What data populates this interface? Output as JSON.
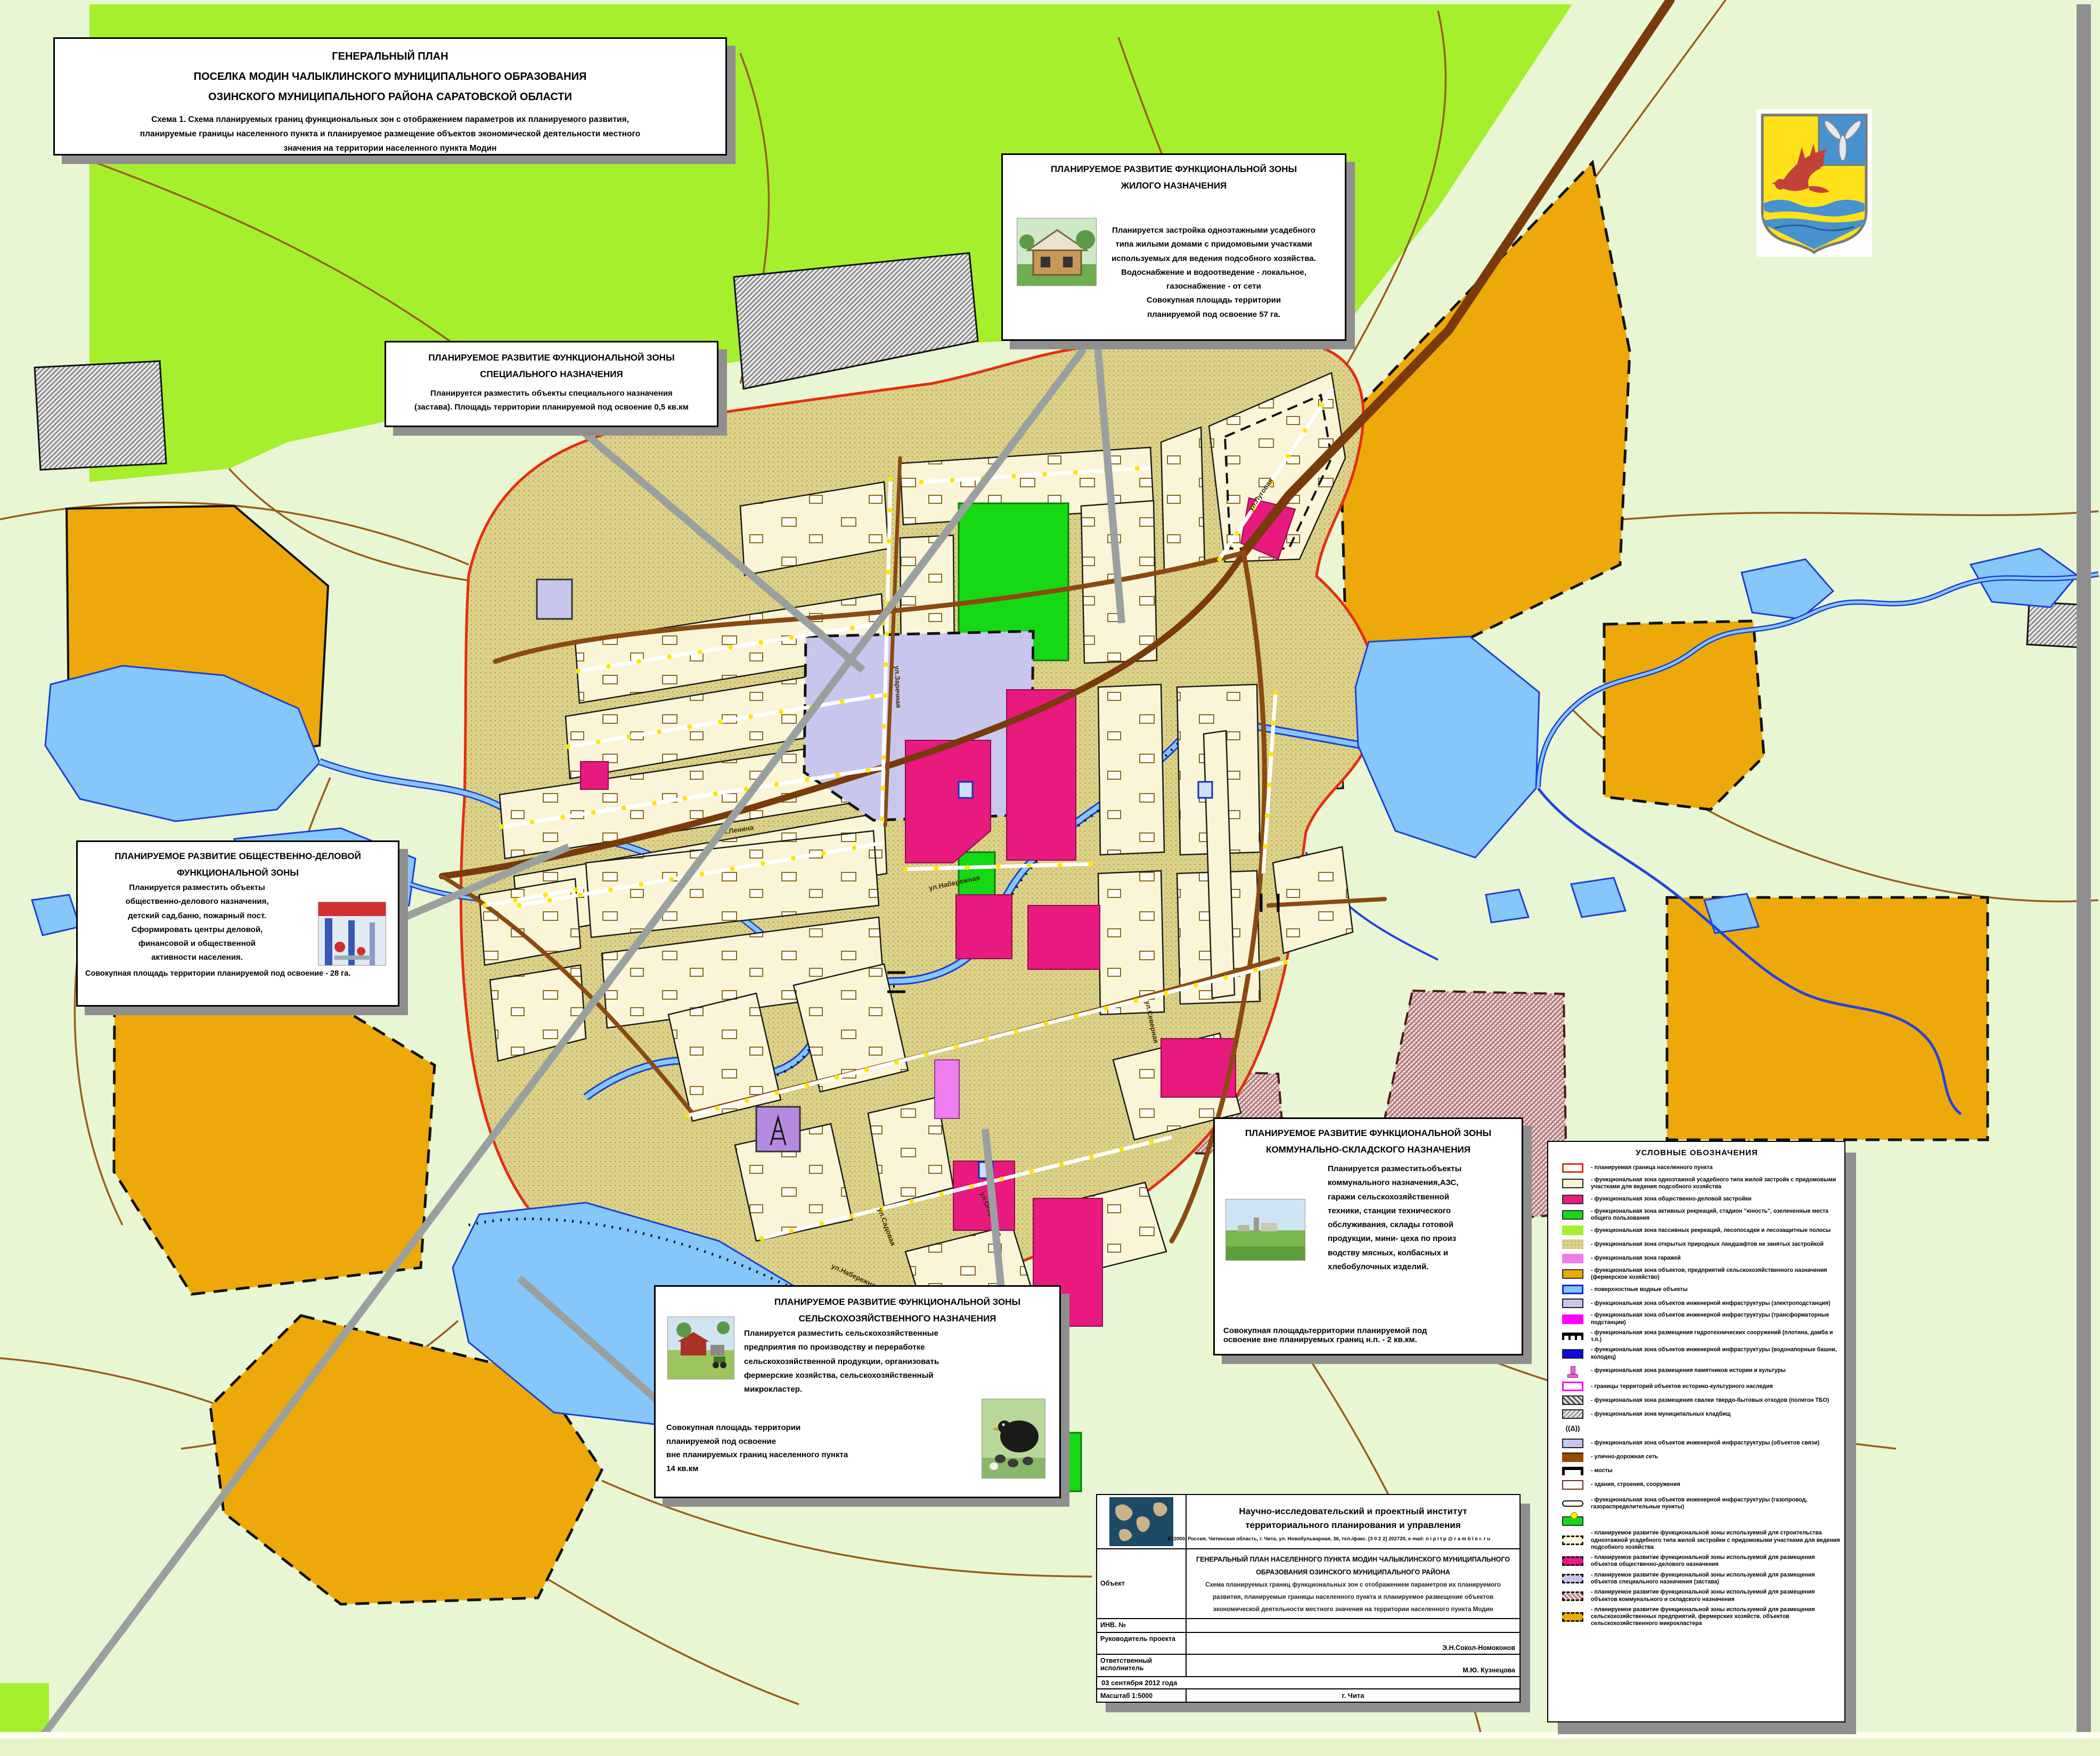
{
  "title_box": {
    "line1": "ГЕНЕРАЛЬНЫЙ ПЛАН",
    "line2": "ПОСЕЛКА МОДИН ЧАЛЫКЛИНСКОГО МУНИЦИПАЛЬНОГО ОБРАЗОВАНИЯ",
    "line3": "ОЗИНСКОГО МУНИЦИПАЛЬНОГО РАЙОНА САРАТОВСКОЙ ОБЛАСТИ",
    "subtitle": "Схема 1. Схема планируемых границ функциональных зон с отображением параметров их планируемого развития,\nпланируемые границы населенного пункта и планируемое размещение объектов экономической деятельности местного\nзначения на  территории населенного пункта Модин"
  },
  "callouts": {
    "residential": {
      "title": "ПЛАНИРУЕМОЕ РАЗВИТИЕ ФУНКЦИОНАЛЬНОЙ  ЗОНЫ\nЖИЛОГО НАЗНАЧЕНИЯ",
      "body": "Планируется застройка одноэтажными усадебного\nтипа жилыми домами с придомовыми участками\nиспользуемых для ведения подсобного хозяйства.\nВодоснабжение и водоотведение - локальное,\nгазоснабжение - от сети\nСовокупная площадь территории\nпланируемой под освоение 57 га."
    },
    "special": {
      "title": "ПЛАНИРУЕМОЕ РАЗВИТИЕ ФУНКЦИОНАЛЬНОЙ  ЗОНЫ\nСПЕЦИАЛЬНОГО  НАЗНАЧЕНИЯ",
      "body": "Планируется разместить объекты специального назначения\n(застава). Площадь территории планируемой под освоение 0,5 кв.км"
    },
    "public_business": {
      "title": "ПЛАНИРУЕМОЕ РАЗВИТИЕ ОБЩЕСТВЕННО-ДЕЛОВОЙ\nФУНКЦИОНАЛЬНОЙ  ЗОНЫ",
      "body": "Планируется разместить объекты\nобщественно-делового назначения,\nдетский сад,баню, пожарный пост.\nСформировать центры деловой,\nфинансовой и общественной\nактивности населения.",
      "footer": "Совокупная площадь территории планируемой под освоение - 28 га."
    },
    "agricultural": {
      "title": "ПЛАНИРУЕМОЕ РАЗВИТИЕ ФУНКЦИОНАЛЬНОЙ  ЗОНЫ\nСЕЛЬСКОХОЗЯЙСТВЕННОГО НАЗНАЧЕНИЯ",
      "body": "Планируется разместить сельскохозяйственные\nпредприятия по производству и переработке\nсельскохозяйственной продукции, организовать\nфермерские  хозяйства, сельскохозяйственный\nмикрокластер.",
      "footer": "Совокупная площадь территории\nпланируемой под освоение\nвне планируемых границ населенного пункта\n14 кв.км"
    },
    "communal": {
      "title": "ПЛАНИРУЕМОЕ РАЗВИТИЕ ФУНКЦИОНАЛЬНОЙ  ЗОНЫ\nКОММУНАЛЬНО-СКЛАДСКОГО НАЗНАЧЕНИЯ",
      "body": "Планируется разместитьобъекты\nкоммунального назначения,АЗС,\nгаражи сельскохозяйственной\nтехники, станции технического\nобслуживания, склады готовой\nпродукции, мини- цеха по произ\nводству мясных, колбасных и\nхлебобулочных изделий.",
      "footer": "Совокупная площадьтерритории планируемой под\nосвоение вне планируемых границ н.п. - 2 кв.км."
    }
  },
  "legend": {
    "title": "УСЛОВНЫЕ ОБОЗНАЧЕНИЯ",
    "items": [
      {
        "label": "- планируемая граница населенного пункта"
      },
      {
        "label": "- функциональная зона одноэтажной усадебного типа жилой застройк с придомовыми участками для ведения подсобного хозяйства"
      },
      {
        "label": "- функциональная зона общественно-деловой застройки"
      },
      {
        "label": "- функциональная зона активных рекреаций, стадион \"юность\", озелененные места общего пользования"
      },
      {
        "label": "- функциональная зона пассивных рекреаций, лесопосадки и лесозащитные полосы"
      },
      {
        "label": "- функциональная зона открытых природных ландшафтов не занятых застройкой"
      },
      {
        "label": "- функциональная зона гаражей"
      },
      {
        "label": "- функциональная зона объектов, предприятий сельскохозяйственного назначения (фермерское хозяйство)"
      },
      {
        "label": "- поверхностные водные объекты"
      },
      {
        "label": "- функциональная зона объектов инженерной инфраструктуры (электроподстанция)"
      },
      {
        "label": "- функциональная зона объектов инженерной инфраструктуры (трансформаторные подстанции)"
      },
      {
        "label": "- функциональная зона размещения гидротехнических сооружений (плотина, дамба и т.п.)"
      },
      {
        "label": "- функциональная зона объектов инженерной инфраструктуры (водонапорные башни, колодец)"
      },
      {
        "label": "- функциональная зона размещения памятников истории и культуры"
      },
      {
        "label": "- границы территорий объектов историко-культурного наследия"
      },
      {
        "label": "- функциональная зона размещения свалки твердо-бытовых отходов (полигон ТБО)"
      },
      {
        "label": "- функциональная зона муниципальных кладбищ"
      },
      {
        "label": ""
      },
      {
        "label": "- функциональная зона объектов инженерной инфраструктуры (объектов связи)"
      },
      {
        "label": "- улично-дорожная сеть"
      },
      {
        "label": "- мосты"
      },
      {
        "label": "- здания, строения, сооружения"
      },
      {
        "label": "- функциональная зона объектов инженерной инфраструктуры (газопровод,  газораспределительные пункты)"
      },
      {
        "label": ""
      },
      {
        "label": "- планируемое развитие функциональной зоны используемой для строительства одноэтажной усадебного типа жилой застройки с придомовыми участками для ведения подсобного хозяйства"
      },
      {
        "label": "- планируемое развитие функциональной зоны используемой для размещения объектов общественно-делового назначения"
      },
      {
        "label": "- планируемое развитие функциональной зоны используемой для размещения объектов специального назначения (застава)"
      },
      {
        "label": "- планируемое развитие функциональной зоны используемой для размещения объектов коммунального и складского назначения"
      },
      {
        "label": "- планируемое развитие функциональной зоны используемой для размещения сельскохозяйственных предприятий, фермерских хозяйств. объектов сельскохозяйственного микрокластера"
      }
    ],
    "tower_glyph": "((Δ))"
  },
  "stamp": {
    "institute": "Научно-исследовательский  и  проектный  институт\nтерриториального  планирования  и   управления",
    "address": "672000, Россия, Читинская область, г. Чита, ул. Новобульварная, 36, тел./факс. [3 0 2 2] 202720, e mail: n i p i t p @ r a m b l e r. r u",
    "object_label": "Объект",
    "object_title": "ГЕНЕРАЛЬНЫЙ ПЛАН НАСЕЛЕННОГО ПУНКТА МОДИН ЧАЛЫКЛИНСКОГО МУНИЦИПАЛЬНОГО ОБРАЗОВАНИЯ ОЗИНСКОГО МУНИЦИПАЛЬНОГО РАЙОНА",
    "object_sub": "Схема планируемых границ функциональных зон с отображением параметров их планируемого развития, планируемые границы населенного пункта и планируемое размещение объектов экономической деятельности местного значения на территории населенного пункта Модин",
    "inv_label": "ИНВ. №",
    "lead_label": "Руководитель проекта",
    "lead_name": "Э.Н.Сокол-Номоконов",
    "resp_label": "Ответственный исполнитель",
    "resp_name": "М.Ю. Кузнецова",
    "date": "03 сентября 2012 года",
    "scale": "Масштаб 1:5000",
    "city": "г. Чита"
  },
  "map": {
    "street_names": [
      "ул.Ленина",
      "ул.Заречная",
      "ул.Луговая",
      "ул.Набережная",
      "ул.Северная",
      "ул.Огородная",
      "ул.Садовая"
    ],
    "colors": {
      "background": "#e9f6d3",
      "boundary_red": "#e22f12",
      "village_khaki": "#ddd28c",
      "residential_cream": "#faf5d8",
      "public_business_magenta": "#e8197f",
      "recreation_green": "#16d916",
      "passive_recreation_lime": "#a5ef2d",
      "farm_orange": "#eda909",
      "water_blue": "#85c7fa",
      "special_lavender": "#c9c6ee",
      "garage_violet": "#ee7ef0",
      "road_brown": "#7a3a0c",
      "field_road": "#9a5d20",
      "leader_grey": "#9aa0a0"
    }
  }
}
